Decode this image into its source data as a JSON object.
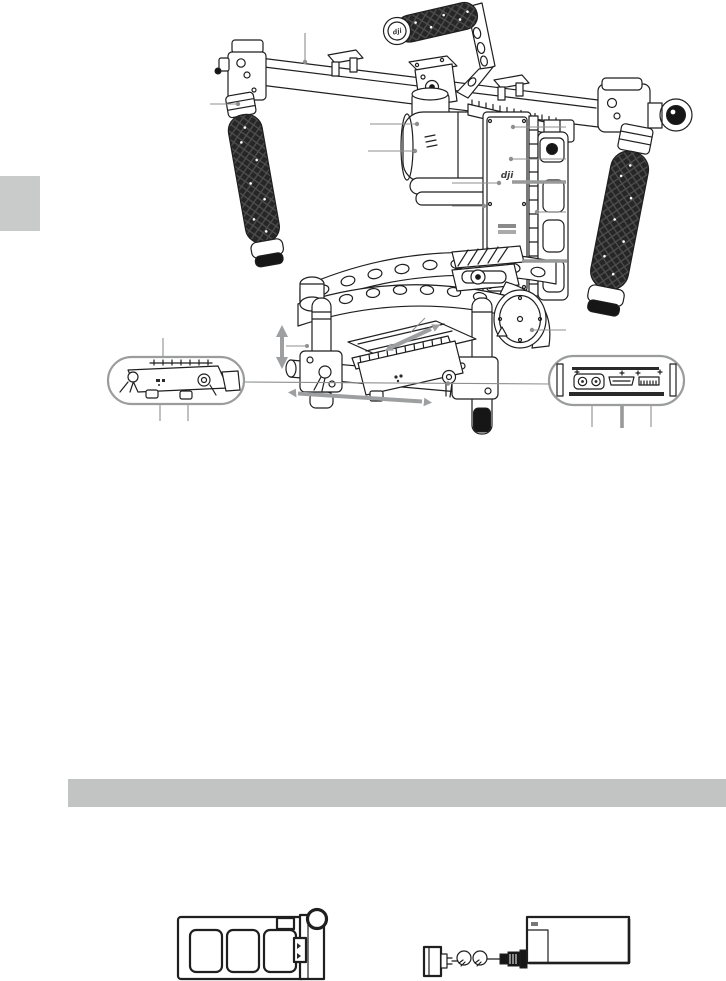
{
  "page": {
    "kind": "user-manual-diagram-page",
    "background": "#ffffff"
  },
  "colors": {
    "page_bg": "#ffffff",
    "ink": "#1f1f1f",
    "leader": "#8d8f90",
    "thick_leader": "#98999a",
    "arrow": "#9d9fa0",
    "bubble_stroke": "#9a9c9d",
    "section_bar": "#c2c3c3",
    "side_tab": "#c9caca",
    "grip_dark": "#242424",
    "metal_dark": "#161616"
  },
  "branding": {
    "logo_text": "dji"
  },
  "figures": {
    "main": {
      "name": "handheld-gimbal-diagram"
    },
    "detail_left": {
      "name": "camera-mounting-plate-detail"
    },
    "detail_right": {
      "name": "rear-port-panel-detail",
      "ports": [
        "power-ports",
        "hdmi-port",
        "pin-connector"
      ]
    },
    "bottom_left": {
      "name": "battery"
    },
    "bottom_right": {
      "name": "power-adapter-with-plug"
    }
  }
}
